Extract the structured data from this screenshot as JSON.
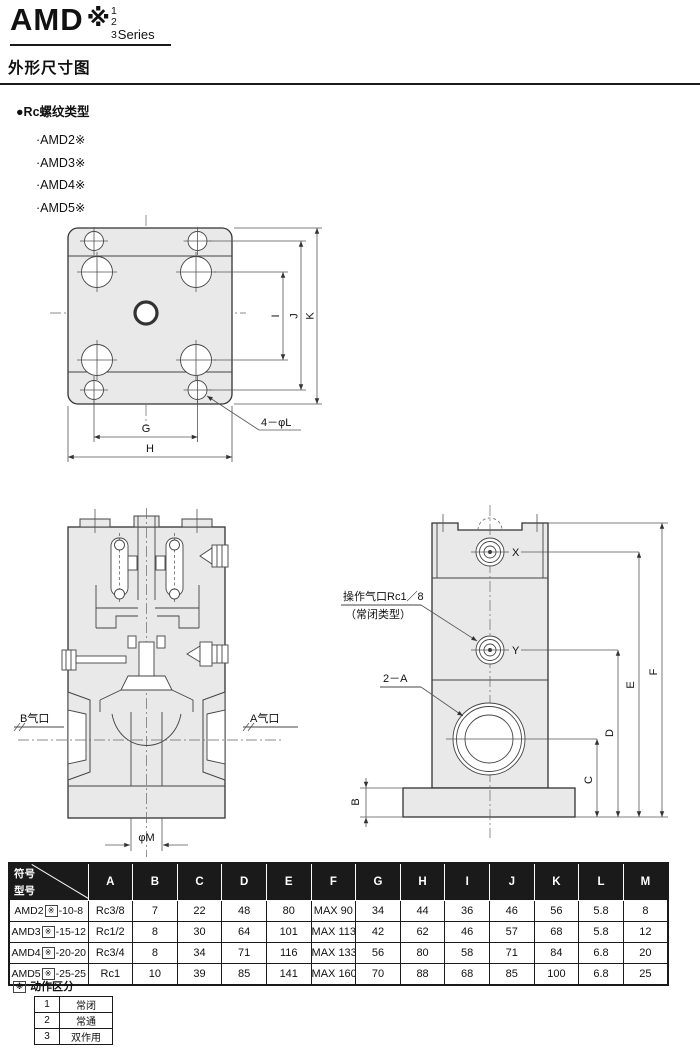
{
  "page": {
    "brand": {
      "title": "AMD",
      "sym": "※",
      "stack": [
        "1",
        "2",
        "3"
      ],
      "series": "Series"
    },
    "section_title": "外形尺寸图",
    "subsection": "●Rc螺纹类型",
    "models": [
      "·AMD2※",
      "·AMD3※",
      "·AMD4※",
      "·AMD5※"
    ]
  },
  "drawing": {
    "top_view": {
      "dim_g": "G",
      "dim_h": "H",
      "dim_i": "I",
      "dim_j": "J",
      "dim_k": "K",
      "hole_label": "4－φL"
    },
    "section_view": {
      "port_b": "B气口",
      "port_a": "A气口",
      "bore": "φM"
    },
    "side_view": {
      "pilot_line1": "操作气口Rc1／8",
      "pilot_line2": "（常闭类型）",
      "ports_label": "2－A",
      "port_x": "X",
      "port_y": "Y",
      "dim_b": "B",
      "dim_c": "C",
      "dim_d": "D",
      "dim_e": "E",
      "dim_f": "F"
    }
  },
  "dims_table": {
    "corner": {
      "top": "符号",
      "bottom": "型号"
    },
    "columns": [
      "A",
      "B",
      "C",
      "D",
      "E",
      "F",
      "G",
      "H",
      "I",
      "J",
      "K",
      "L",
      "M"
    ],
    "rows": [
      {
        "model_prefix": "AMD2",
        "model_box": "※",
        "model_suffix": "-10-8",
        "values": [
          "Rc3/8",
          "7",
          "22",
          "48",
          "80",
          "MAX 90",
          "34",
          "44",
          "36",
          "46",
          "56",
          "5.8",
          "8"
        ]
      },
      {
        "model_prefix": "AMD3",
        "model_box": "※",
        "model_suffix": "-15-12",
        "values": [
          "Rc1/2",
          "8",
          "30",
          "64",
          "101",
          "MAX 113",
          "42",
          "62",
          "46",
          "57",
          "68",
          "5.8",
          "12"
        ]
      },
      {
        "model_prefix": "AMD4",
        "model_box": "※",
        "model_suffix": "-20-20",
        "values": [
          "Rc3/4",
          "8",
          "34",
          "71",
          "116",
          "MAX 133",
          "56",
          "80",
          "58",
          "71",
          "84",
          "6.8",
          "20"
        ]
      },
      {
        "model_prefix": "AMD5",
        "model_box": "※",
        "model_suffix": "-25-25",
        "values": [
          "Rc1",
          "10",
          "39",
          "85",
          "141",
          "MAX 160",
          "70",
          "88",
          "68",
          "85",
          "100",
          "6.8",
          "25"
        ]
      }
    ]
  },
  "legend": {
    "box": "※",
    "title": "动作区分",
    "rows": [
      {
        "code": "1",
        "label": "常闭"
      },
      {
        "code": "2",
        "label": "常通"
      },
      {
        "code": "3",
        "label": "双作用"
      }
    ]
  }
}
